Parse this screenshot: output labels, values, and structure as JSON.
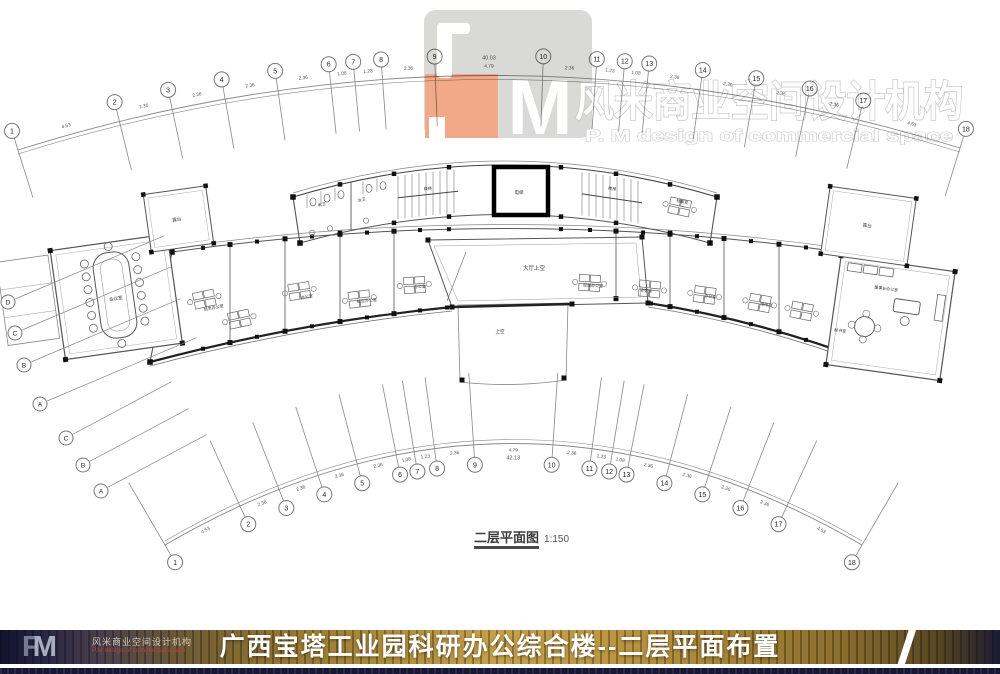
{
  "watermark": {
    "logo_m": "M",
    "company_cn": "风米商业空间设计机构",
    "company_en": "P. M design of commercial space"
  },
  "plan": {
    "caption": "二层平面图",
    "scale": "1:150",
    "grid_top": {
      "labels": [
        "1",
        "2",
        "3",
        "4",
        "5",
        "6",
        "7",
        "8",
        "9",
        "10",
        "11",
        "12",
        "13",
        "14",
        "15",
        "16",
        "17",
        "18"
      ],
      "dims": [
        "4.53",
        "2.36",
        "2.36",
        "2.36",
        "2.36",
        "1.08",
        "1.23",
        "2.36",
        "4.79",
        "2.36",
        "1.23",
        "1.08",
        "2.36",
        "2.36",
        "2.36",
        "2.36",
        "4.53"
      ],
      "total": "40.03"
    },
    "grid_bottom": {
      "labels": [
        "1",
        "2",
        "3",
        "4",
        "5",
        "6",
        "7",
        "8",
        "9",
        "10",
        "11",
        "12",
        "13",
        "14",
        "15",
        "16",
        "17",
        "18"
      ],
      "dims": [
        "4.53",
        "2.36",
        "2.36",
        "2.36",
        "2.36",
        "1.08",
        "1.23",
        "2.36",
        "4.79",
        "2.36",
        "1.23",
        "1.08",
        "2.36",
        "2.36",
        "2.36",
        "2.36",
        "4.53"
      ],
      "total": "42.13"
    },
    "grid_left_upper": {
      "labels": [
        "D",
        "C",
        "B",
        "A"
      ]
    },
    "grid_left_lower": {
      "labels": [
        "C",
        "B",
        "A"
      ]
    },
    "rooms": {
      "elevator": "电梯",
      "toilet_m": "男卫",
      "toilet_f": "女卫",
      "stair_left": "楼梯",
      "stair_right": "楼梯",
      "archive": "档案室",
      "atrium": "大厅上空",
      "canopy": "上空",
      "conference": "会议室",
      "terrace_left": "露台",
      "terrace_right": "露台",
      "office1": "财务办公室",
      "office2": "办公室",
      "office3": "综合办公室",
      "office4": "办公室",
      "office5": "经理办公室",
      "office6": "会客室",
      "office7": "办公室",
      "office8": "接待室",
      "secretary": "秘书室",
      "chairman": "董事长办公室"
    }
  },
  "footer": {
    "title": "广西宝塔工业园科研办公综合楼--二层平面布置",
    "logo_f": "F",
    "logo_m": "M",
    "company_cn": "风米商业空间设计机构",
    "company_en": "P.M design of commercial space"
  }
}
